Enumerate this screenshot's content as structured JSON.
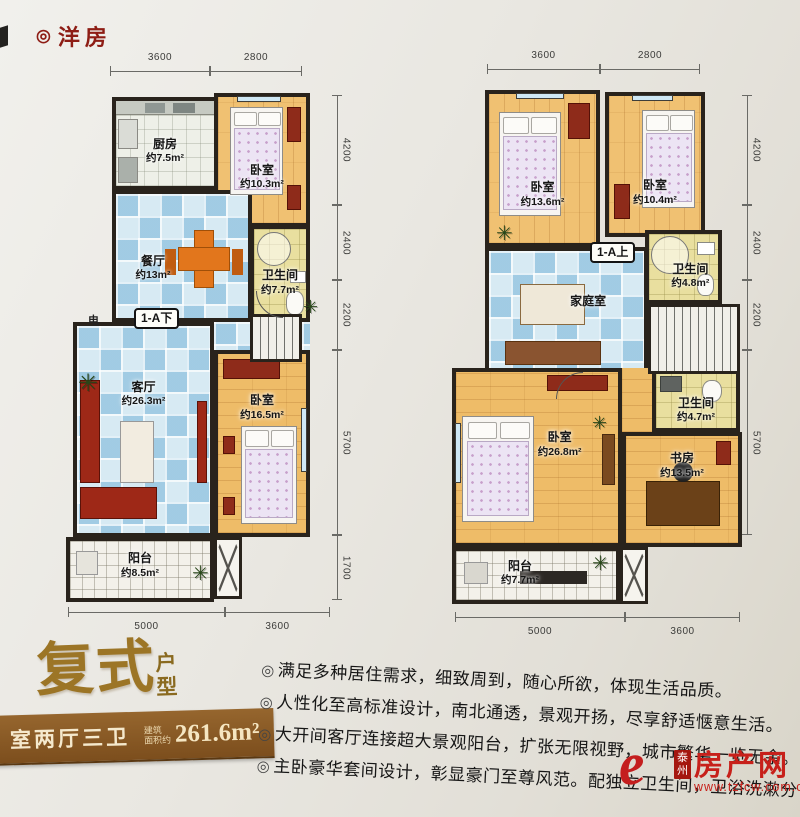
{
  "page": {
    "title": "洋房",
    "title_mark": "◎",
    "bullet_mark": "◎",
    "plant_glyph": "✳"
  },
  "plans": [
    {
      "floor_tag": "1-A下",
      "side_label": "电",
      "dims": {
        "top": [
          "3600",
          "2800"
        ],
        "right": [
          "4200",
          "2400",
          "2200",
          "5700",
          "1700"
        ],
        "bottom": [
          "5000",
          "3600"
        ]
      },
      "rooms": {
        "kitchen": {
          "name": "厨房",
          "area": "约7.5m²"
        },
        "bedroom1": {
          "name": "卧室",
          "area": "约10.3m²"
        },
        "dining": {
          "name": "餐厅",
          "area": "约13m²"
        },
        "bath": {
          "name": "卫生间",
          "area": "约7.7m²"
        },
        "living": {
          "name": "客厅",
          "area": "约26.3m²"
        },
        "bedroom2": {
          "name": "卧室",
          "area": "约16.5m²"
        },
        "balcony": {
          "name": "阳台",
          "area": "约8.5m²"
        }
      }
    },
    {
      "floor_tag": "1-A上",
      "dims": {
        "top": [
          "3600",
          "2800"
        ],
        "right": [
          "4200",
          "2400",
          "2200",
          "5700"
        ],
        "bottom": [
          "5000",
          "3600"
        ]
      },
      "rooms": {
        "bedroom3": {
          "name": "卧室",
          "area": "约13.6m²"
        },
        "bedroom4": {
          "name": "卧室",
          "area": "约10.4m²"
        },
        "family": {
          "name": "家庭室"
        },
        "bath_upper": {
          "name": "卫生间",
          "area": "约4.8m²"
        },
        "bath_lower": {
          "name": "卫生间",
          "area": "约4.7m²"
        },
        "master": {
          "name": "卧室",
          "area": "约26.8m²"
        },
        "study": {
          "name": "书房",
          "area": "约13.5m²"
        },
        "balcony": {
          "name": "阳台",
          "area": "约7.7m²"
        }
      }
    }
  ],
  "footer": {
    "headline": "复式",
    "headline_sub": "户型",
    "banner": {
      "rooms": "室两厅三卫",
      "area_label_top": "建筑",
      "area_label_bottom": "面积约",
      "area_value": "261.6m²"
    },
    "bullets": [
      "满足多种居住需求，细致周到，随心所欲，体现生活品质。",
      "人性化至高标准设计，南北通透，景观开扬，尽享舒适惬意生活。",
      "大开间客厅连接超大景观阳台，扩张无限视野，城市繁华一览无余。",
      "主卧豪华套间设计，彰显豪门至尊风范。配独立卫生间，卫浴洗漱分"
    ],
    "watermark": {
      "logo_char": "e",
      "city": "泰州",
      "site": "房产网",
      "url": "www.tzfcw.com.cn"
    }
  },
  "colors": {
    "accent_red": "#8e1d15",
    "gold": "#9c7526",
    "banner_brown": "#8a5c2a",
    "watermark_red": "#c7201a",
    "wall": "#29231c"
  }
}
